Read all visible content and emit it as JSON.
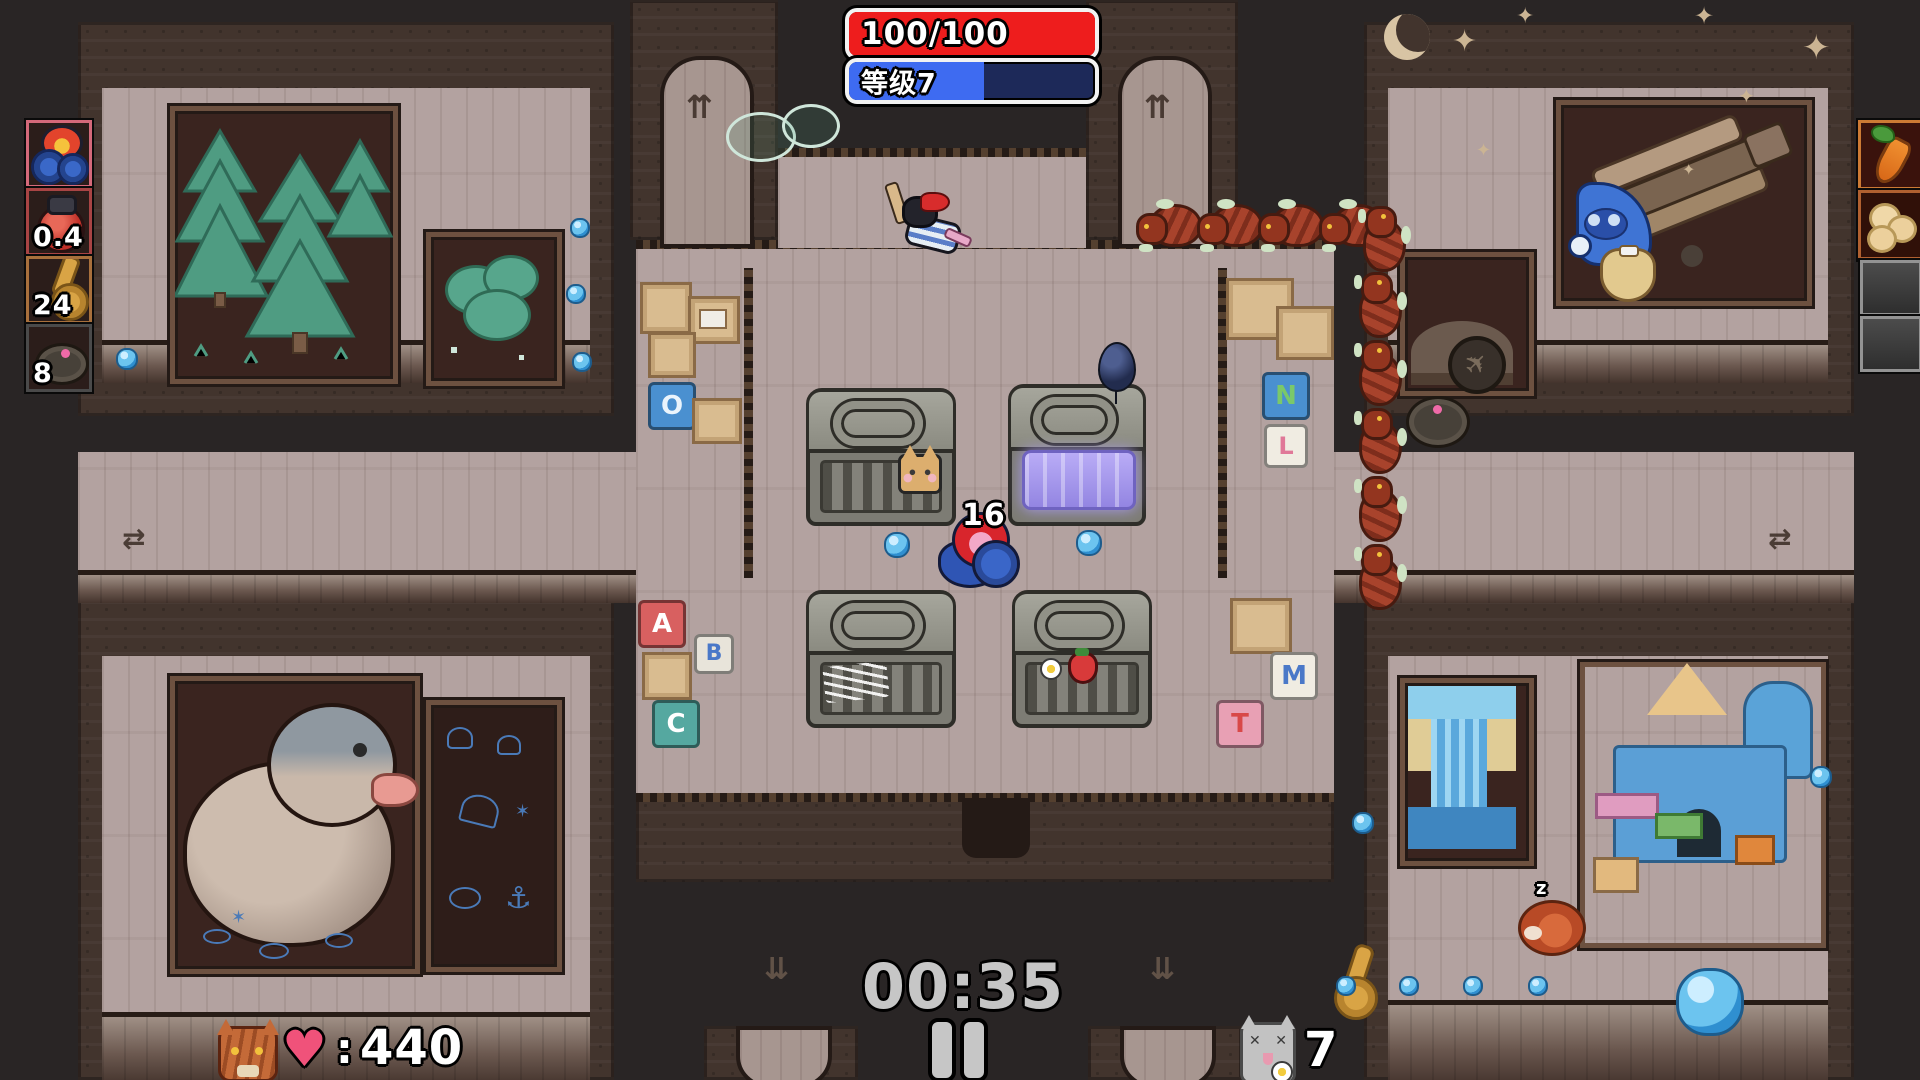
{
  "hud": {
    "health": {
      "text": "100/100",
      "fill_style": "width:100%"
    },
    "level": {
      "text": "等级7",
      "fill_style": "width:55%"
    },
    "timer": {
      "text": "00:35"
    },
    "kills": {
      "heart": "♥",
      "colon": ":",
      "value": "440"
    },
    "cats": {
      "value": "7",
      "x_eye": "✕"
    },
    "player_tag": "16"
  },
  "slots": {
    "weapons": [
      {
        "name": "fire-cannon",
        "count": ""
      },
      {
        "name": "bomb",
        "count": "0.4"
      },
      {
        "name": "saxophone",
        "count": "24"
      },
      {
        "name": "landmine",
        "count": "8"
      }
    ],
    "items": [
      {
        "name": "carrot"
      },
      {
        "name": "popcorn"
      },
      {
        "name": "empty"
      },
      {
        "name": "empty"
      }
    ]
  },
  "map": {
    "letter_blocks_left": [
      "O",
      "A",
      "B",
      "C"
    ],
    "letter_blocks_right": [
      "N",
      "L",
      "M",
      "T"
    ],
    "arrow_up": "⇈",
    "arrow_down": "⇊",
    "arrow_lr": "⇄",
    "star": "✦",
    "sleep_z": "z",
    "plane_glyph": "✈",
    "chalk_anchor": "⚓",
    "chalk_star": "✶"
  },
  "colors": {
    "health_fill": "#ee1d1d",
    "level_fill": "#3e6bf1",
    "level_bg": "#1d2959",
    "timer_text": "#c6c6c6",
    "floor": "#b3a2a0",
    "wall_dark": "#42342d",
    "dark_room": "#3a241f",
    "gem_blue": "#55b1e6"
  }
}
